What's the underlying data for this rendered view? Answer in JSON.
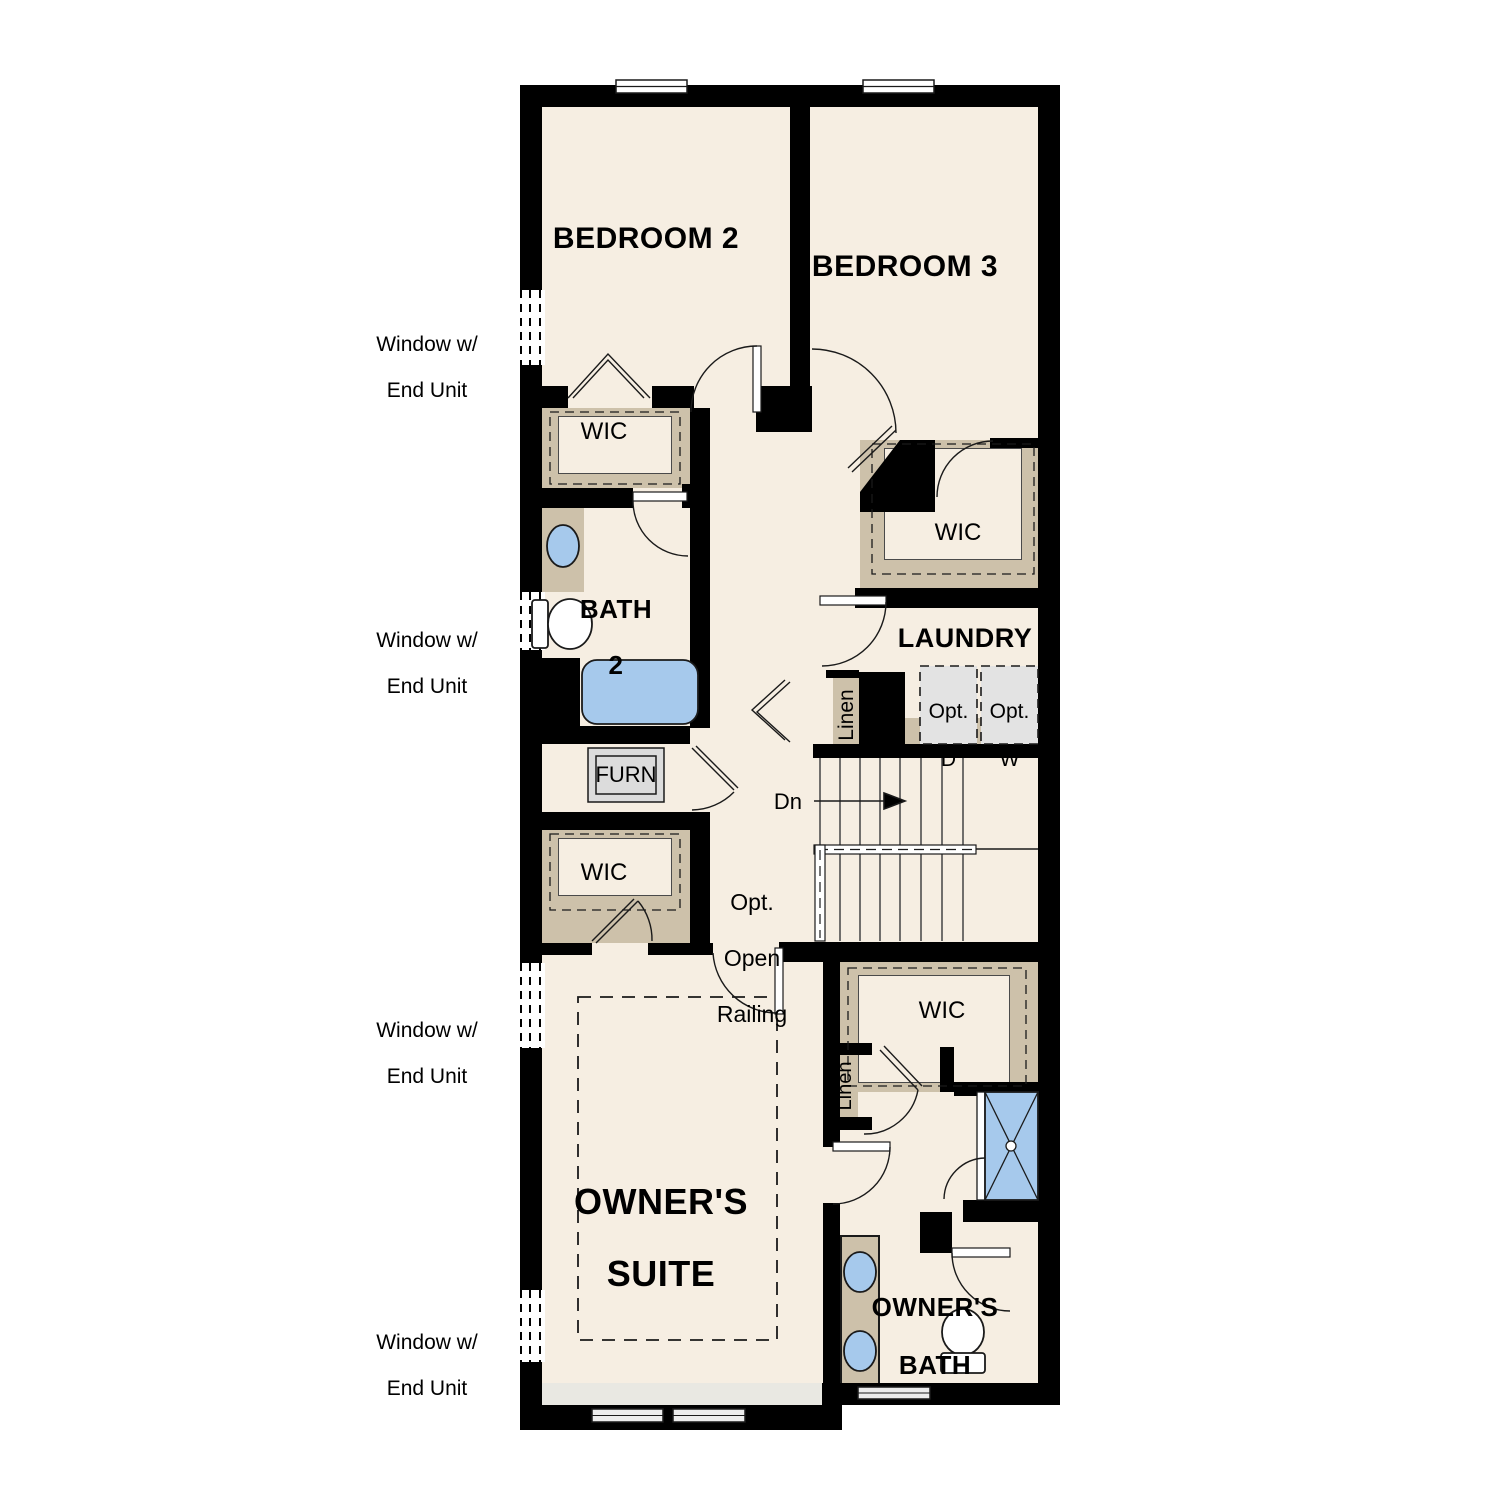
{
  "plan": {
    "rooms": {
      "bedroom2": "BEDROOM 2",
      "bedroom3": "BEDROOM 3",
      "wic": "WIC",
      "bath2": {
        "line1": "BATH",
        "line2": "2"
      },
      "laundry": "LAUNDRY",
      "owners_suite": {
        "line1": "OWNER'S",
        "line2": "SUITE"
      },
      "owners_bath": {
        "line1": "OWNER'S",
        "line2": "BATH"
      }
    },
    "features": {
      "furnace": "FURN",
      "linen": "Linen",
      "stairs_down": "Dn",
      "opt_open_railing": {
        "line1": "Opt.",
        "line2": "Open",
        "line3": "Railing"
      },
      "opt_dryer": {
        "line1": "Opt.",
        "line2": "D"
      },
      "opt_washer": {
        "line1": "Opt.",
        "line2": "W"
      }
    },
    "annotations": {
      "window_end_unit": {
        "line1": "Window w/",
        "line2": "End Unit"
      }
    },
    "colors": {
      "wall": "#000000",
      "line": "#1a1a1a",
      "floor": "#f6eee2",
      "closet_shelf": "#cdc1aa",
      "fixture_blue": "#a6c9ec",
      "appliance_grey": "#e3e3e3",
      "furn_grey": "#dcdcdc",
      "patio_band": "#e9e8e2",
      "window_grey": "#ececec"
    }
  }
}
